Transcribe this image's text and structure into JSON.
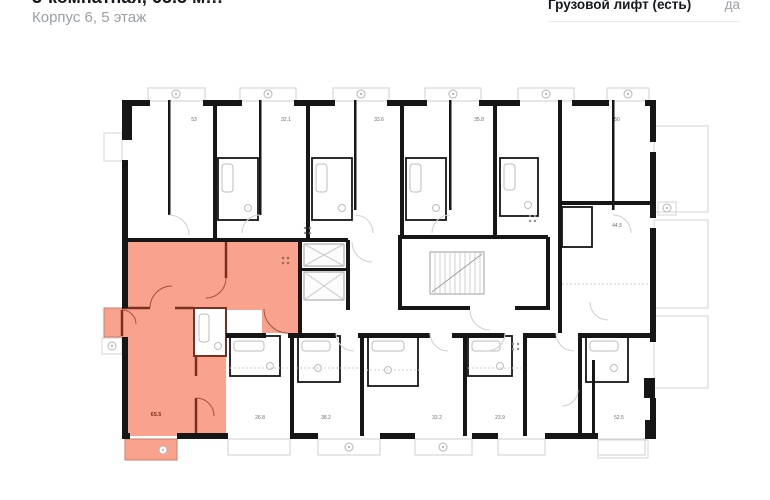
{
  "header": {
    "title_clipped": "3-комнатная, 65.5 м…",
    "subtitle": "Корпус 6, 5 этаж",
    "spec_label": "Грузовой лифт (есть)",
    "spec_value": "да"
  },
  "plan": {
    "highlighted_flat_area": "65.5",
    "highlight_color": "#f9a38e",
    "highlight_wall_color": "#7a2f20",
    "wall_color": "#161616",
    "fixture_color": "#c9c9c9",
    "room_areas": [
      "53",
      "32.1",
      "33.6",
      "35.8",
      "50",
      "44.5",
      "26.8",
      "38.2",
      "33.2",
      "23.9",
      "52.5"
    ]
  }
}
